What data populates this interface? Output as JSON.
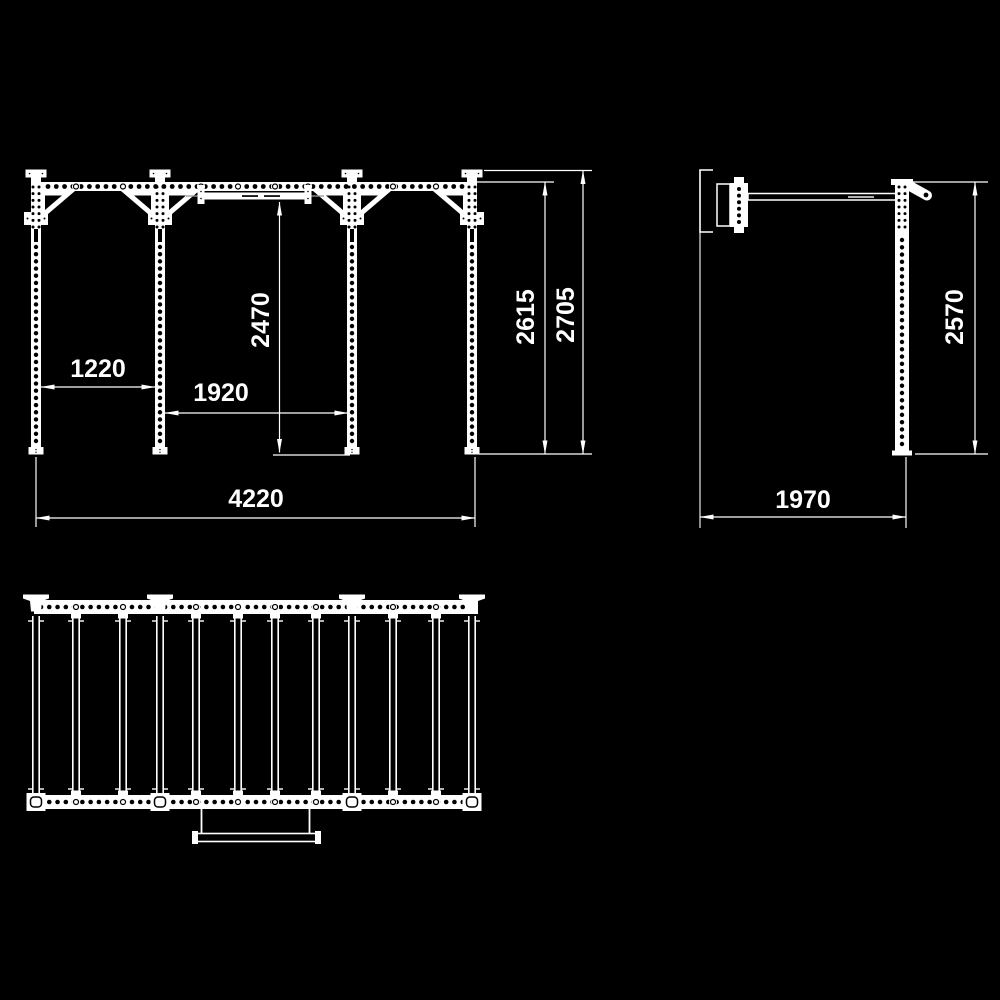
{
  "page": {
    "background": "#000000",
    "line_color": "#ffffff"
  },
  "drawing": {
    "views": [
      "front-elevation",
      "side-elevation",
      "plan-view"
    ]
  },
  "dimensions": {
    "front": {
      "left_bay": "1220",
      "center_bay": "1920",
      "pullup_bar_height": "2470",
      "beam_height": "2615",
      "overall_height": "2705",
      "overall_width": "4220"
    },
    "side": {
      "height": "2570",
      "depth": "1970"
    }
  }
}
